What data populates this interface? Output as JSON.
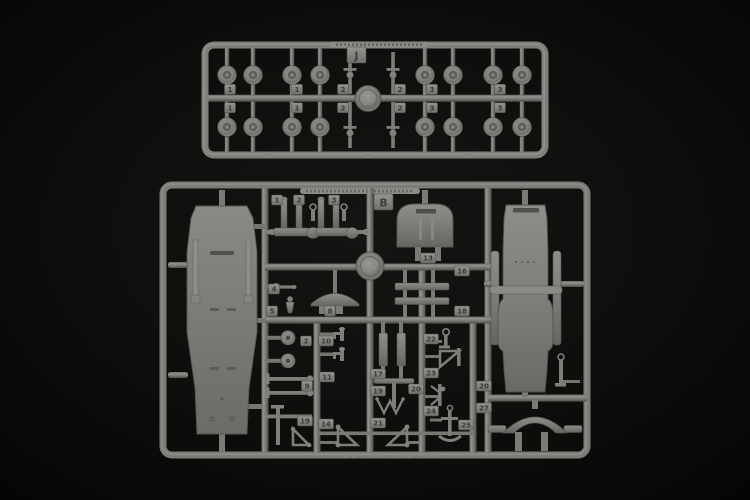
{
  "image_type": "photograph",
  "subject": "Two gray injection-molded plastic model kit sprues on a black background",
  "colors": {
    "background": "#0b0b0a",
    "plastic_mid": "#7e7e7a",
    "plastic_light": "#9a9a95",
    "plastic_dark": "#54544f",
    "engraving": "#3c3c37"
  },
  "sprue_top": {
    "letter_tag": "J",
    "molded_text_strip": "illegible",
    "wheel_xs": [
      227,
      253,
      292,
      320,
      425,
      453,
      493,
      522
    ],
    "wheel_rows": [
      75,
      127
    ],
    "axle_xs": [
      350,
      393
    ],
    "number_tags": [
      {
        "x": 230,
        "label": "1"
      },
      {
        "x": 297,
        "label": "1"
      },
      {
        "x": 343,
        "label": "2"
      },
      {
        "x": 400,
        "label": "2"
      },
      {
        "x": 432,
        "label": "3"
      },
      {
        "x": 500,
        "label": "3"
      }
    ]
  },
  "sprue_main": {
    "letter_tag": "B",
    "molded_text_strip": "illegible",
    "number_tags": [
      {
        "x": 277,
        "y": 195,
        "label": "1"
      },
      {
        "x": 299,
        "y": 195,
        "label": "2"
      },
      {
        "x": 334,
        "y": 195,
        "label": "3"
      },
      {
        "x": 428,
        "y": 253,
        "label": "13"
      },
      {
        "x": 274,
        "y": 284,
        "label": "4"
      },
      {
        "x": 272,
        "y": 306,
        "label": "5"
      },
      {
        "x": 330,
        "y": 306,
        "label": "8"
      },
      {
        "x": 462,
        "y": 266,
        "label": "16"
      },
      {
        "x": 462,
        "y": 306,
        "label": "18"
      },
      {
        "x": 306,
        "y": 336,
        "label": "2"
      },
      {
        "x": 326,
        "y": 336,
        "label": "10"
      },
      {
        "x": 307,
        "y": 381,
        "label": "9"
      },
      {
        "x": 327,
        "y": 372,
        "label": "11"
      },
      {
        "x": 305,
        "y": 416,
        "label": "19"
      },
      {
        "x": 326,
        "y": 419,
        "label": "14"
      },
      {
        "x": 378,
        "y": 369,
        "label": "17"
      },
      {
        "x": 378,
        "y": 386,
        "label": "19"
      },
      {
        "x": 416,
        "y": 384,
        "label": "20"
      },
      {
        "x": 378,
        "y": 418,
        "label": "21"
      },
      {
        "x": 431,
        "y": 334,
        "label": "22"
      },
      {
        "x": 431,
        "y": 368,
        "label": "23"
      },
      {
        "x": 431,
        "y": 406,
        "label": "24"
      },
      {
        "x": 466,
        "y": 420,
        "label": "25"
      },
      {
        "x": 484,
        "y": 381,
        "label": "20"
      },
      {
        "x": 484,
        "y": 403,
        "label": "27"
      }
    ]
  }
}
